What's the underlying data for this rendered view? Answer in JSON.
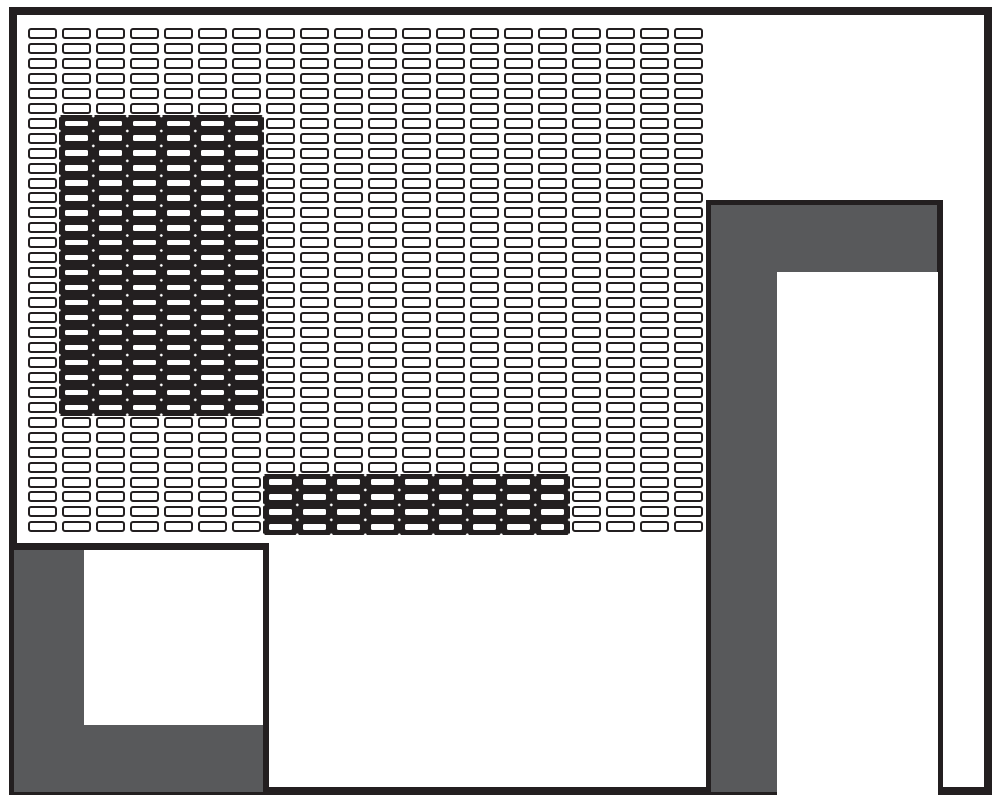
{
  "meta": {
    "description": "Monochrome facility/rack layout diagram: dense grid of outlined bins, two black highlighted bin regions, gray corner structure at right, gray framed structure at bottom-left",
    "canvas_width": 1000,
    "canvas_height": 803
  },
  "colors": {
    "outline_black": "#231f20",
    "structure_gray": "#58595b",
    "background_white": "#ffffff"
  },
  "outer_border": {
    "x": 9,
    "y": 7,
    "width": 983,
    "height": 788,
    "stroke_width": 8
  },
  "grid": {
    "columns": 20,
    "rows": 34,
    "origin_x": 28,
    "origin_y": 28,
    "pitch_x": 34,
    "pitch_y": 14.95,
    "cell_width": 28.6,
    "cell_height": 11,
    "cell_border_width": 2.6,
    "cell_corner_radius": 3,
    "region_padding": 3,
    "highlight_regions": [
      {
        "name": "highlight-block-upper-left",
        "col_start": 1,
        "col_end": 6,
        "row_start": 6,
        "row_end": 25
      },
      {
        "name": "highlight-strip-lower-middle",
        "col_start": 7,
        "col_end": 15,
        "row_start": 30,
        "row_end": 33
      }
    ]
  },
  "structures": {
    "right": {
      "x": 706,
      "y": 200,
      "width": 237,
      "height": 592,
      "border_top": 5,
      "border_left": 5,
      "border_right": 6,
      "interior": {
        "left": 66,
        "top": 67,
        "width": 161,
        "height": 525
      }
    },
    "bottom_left": {
      "x": 14,
      "y": 543,
      "width": 255,
      "height": 249,
      "border_top": 7,
      "border_right": 6,
      "interior": {
        "left": 70,
        "top": 0,
        "width": 179,
        "height": 175
      }
    }
  }
}
